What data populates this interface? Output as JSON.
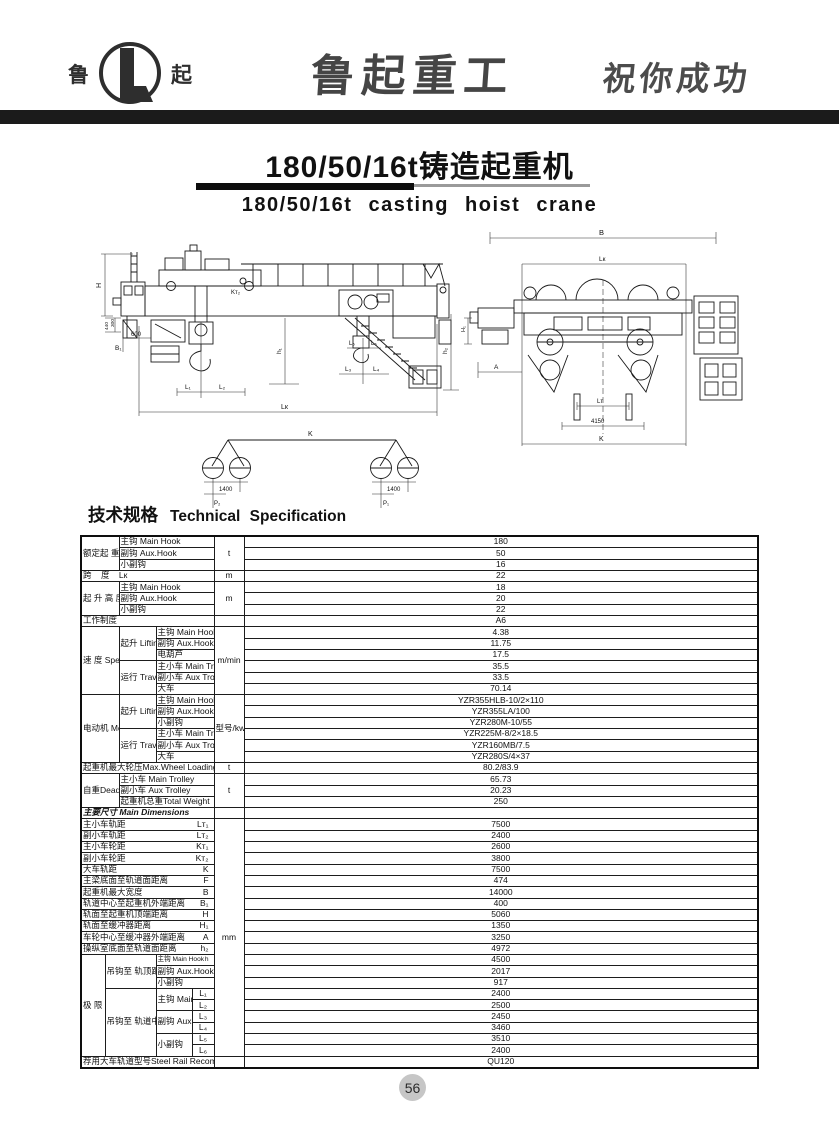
{
  "header": {
    "logo": {
      "left_char": "鲁",
      "right_char": "起"
    },
    "brand_calligraphy": "鲁起重工",
    "slogan_calligraphy": "祝你成功"
  },
  "title": {
    "zh": "180/50/16t铸造起重机",
    "en": "180/50/16t casting hoist crane"
  },
  "section_heading": {
    "zh": "技术规格",
    "en": "Technical Specification"
  },
  "page_number": "56",
  "drawings": {
    "front_view": {
      "labels": {
        "H": "H",
        "d300": "300",
        "d440": "440",
        "B1": "B₁",
        "d600": "600",
        "Kt2": "Kт₂",
        "h1": "h₁",
        "h2": "h₂",
        "L1": "L₁",
        "L2": "L₂",
        "L3": "L₃",
        "L4": "L₄",
        "L5": "L₅",
        "L6": "L₆",
        "Lk": "Lк"
      }
    },
    "end_view": {
      "labels": {
        "B": "B",
        "Lk": "Lк",
        "H1": "H₁",
        "A": "A",
        "Lt": "Lт",
        "d4150": "4150",
        "K": "K"
      }
    },
    "axle_detail": {
      "labels": {
        "K": "K",
        "gauge_left": "1400",
        "gauge_right": "1400",
        "P2": "P₂",
        "P1": "P₁"
      }
    }
  },
  "table": {
    "rows": [
      {
        "cells": [
          {
            "t": "额定起\n重量Cap.",
            "rs": 3,
            "cs": 2,
            "cls": "c"
          },
          {
            "t": "主钩  Main Hook",
            "cs": 3,
            "cls": "l"
          },
          {
            "t": "t",
            "rs": 3,
            "cls": "u"
          },
          {
            "t": "180",
            "cls": "v"
          }
        ]
      },
      {
        "cells": [
          {
            "t": "副钩  Aux.Hook",
            "cs": 3,
            "cls": "l"
          },
          {
            "t": "50",
            "cls": "v"
          }
        ]
      },
      {
        "cells": [
          {
            "t": "小副钩",
            "cs": 3,
            "cls": "l"
          },
          {
            "t": "16",
            "cls": "v"
          }
        ]
      },
      {
        "cells": [
          {
            "t": "跨    度    Lк",
            "cs": 5,
            "cls": "l"
          },
          {
            "t": "m",
            "cls": "u"
          },
          {
            "t": "22",
            "cls": "v"
          }
        ]
      },
      {
        "cells": [
          {
            "t": "起 升 高 度",
            "rs": 3,
            "cs": 2,
            "cls": "c"
          },
          {
            "t": "主钩  Main Hook",
            "cs": 3,
            "cls": "l"
          },
          {
            "t": "m",
            "rs": 3,
            "cls": "u"
          },
          {
            "t": "18",
            "cls": "v"
          }
        ]
      },
      {
        "cells": [
          {
            "t": "副钩  Aux.Hook",
            "cs": 3,
            "cls": "l"
          },
          {
            "t": "20",
            "cls": "v"
          }
        ]
      },
      {
        "cells": [
          {
            "t": "小副钩",
            "cs": 3,
            "cls": "l"
          },
          {
            "t": "22",
            "cls": "v"
          }
        ]
      },
      {
        "cells": [
          {
            "t": "工作制度",
            "cs": 5,
            "cls": "l"
          },
          {
            "t": "",
            "cls": "u"
          },
          {
            "t": "A6",
            "cls": "v"
          }
        ]
      },
      {
        "cells": [
          {
            "t": "速\n度\nSpeed",
            "rs": 6,
            "cs": 2,
            "cls": "c"
          },
          {
            "t": "起升\nLifting",
            "rs": 3,
            "cls": "c"
          },
          {
            "t": "主钩 Main Hook",
            "cs": 2,
            "cls": "ls"
          },
          {
            "t": "m/min",
            "rs": 6,
            "cls": "u"
          },
          {
            "t": "4.38",
            "cls": "v"
          }
        ]
      },
      {
        "cells": [
          {
            "t": "副钩 Aux.Hook",
            "cs": 2,
            "cls": "ls"
          },
          {
            "t": "11.75",
            "cls": "v"
          }
        ]
      },
      {
        "cells": [
          {
            "t": "电葫芦",
            "cs": 2,
            "cls": "ls"
          },
          {
            "t": "17.5",
            "cls": "v"
          }
        ]
      },
      {
        "cells": [
          {
            "t": "运行\nTraveling",
            "rs": 3,
            "cls": "c"
          },
          {
            "t": "主小车 Main Trolley",
            "cs": 2,
            "cls": "ls"
          },
          {
            "t": "35.5",
            "cls": "v"
          }
        ]
      },
      {
        "cells": [
          {
            "t": "副小车 Aux Trolley",
            "cs": 2,
            "cls": "ls"
          },
          {
            "t": "33.5",
            "cls": "v"
          }
        ]
      },
      {
        "cells": [
          {
            "t": "大车",
            "cs": 2,
            "cls": "ls"
          },
          {
            "t": "70.14",
            "cls": "v"
          }
        ]
      },
      {
        "cells": [
          {
            "t": "电动机\n\nMotor",
            "rs": 6,
            "cs": 2,
            "cls": "c"
          },
          {
            "t": "起升\nLifting",
            "rs": 3,
            "cls": "c"
          },
          {
            "t": "主钩 Main Hook",
            "cs": 2,
            "cls": "ls"
          },
          {
            "t": "型号/kw\nType/kw",
            "rs": 6,
            "cls": "u"
          },
          {
            "t": "YZR355HLB-10/2×110",
            "cls": "v"
          }
        ]
      },
      {
        "cells": [
          {
            "t": "副钩 Aux.Hook",
            "cs": 2,
            "cls": "ls"
          },
          {
            "t": "YZR355LA/100",
            "cls": "v"
          }
        ]
      },
      {
        "cells": [
          {
            "t": "小副钩",
            "cs": 2,
            "cls": "ls"
          },
          {
            "t": "YZR280M-10/55",
            "cls": "v"
          }
        ]
      },
      {
        "cells": [
          {
            "t": "运行\nTraveling",
            "rs": 3,
            "cls": "c"
          },
          {
            "t": "主小车 Main Trolley",
            "cs": 2,
            "cls": "ls"
          },
          {
            "t": "YZR225M-8/2×18.5",
            "cls": "v"
          }
        ]
      },
      {
        "cells": [
          {
            "t": "副小车 Aux Trolley",
            "cs": 2,
            "cls": "ls"
          },
          {
            "t": "YZR160MB/7.5",
            "cls": "v"
          }
        ]
      },
      {
        "cells": [
          {
            "t": "大车",
            "cs": 2,
            "cls": "ls"
          },
          {
            "t": "YZR280S/4×37",
            "cls": "v"
          }
        ]
      },
      {
        "cells": [
          {
            "t": "起重机最大轮压Max.Wheel Loading P₁/P₂",
            "cs": 5,
            "cls": "sm"
          },
          {
            "t": "t",
            "cls": "u"
          },
          {
            "t": "80.2/83.9",
            "cls": "v"
          }
        ]
      },
      {
        "cells": [
          {
            "t": "自重Dead-\nWeight",
            "rs": 3,
            "cs": 2,
            "cls": "c"
          },
          {
            "t": "主小车 Main Trolley",
            "cs": 3,
            "cls": "l"
          },
          {
            "t": "t",
            "rs": 3,
            "cls": "u"
          },
          {
            "t": "65.73",
            "cls": "v"
          }
        ]
      },
      {
        "cells": [
          {
            "t": "副小车 Aux Trolley",
            "cs": 3,
            "cls": "l"
          },
          {
            "t": "20.23",
            "cls": "v"
          }
        ]
      },
      {
        "cells": [
          {
            "t": "起重机总重Total Weight",
            "cs": 3,
            "cls": "l"
          },
          {
            "t": "250",
            "cls": "v"
          }
        ]
      },
      {
        "cells": [
          {
            "t": "主要尺寸 Main Dimensions",
            "cs": 5,
            "cls": "hdr"
          },
          {
            "t": "",
            "cls": "u"
          },
          {
            "t": "",
            "cls": "v"
          }
        ]
      },
      {
        "cells": [
          {
            "t": "主小车轨距",
            "sym": "Lт₁",
            "cs": 5,
            "cls": "dim"
          },
          {
            "t": "mm",
            "rs": 21,
            "cls": "u"
          },
          {
            "t": "7500",
            "cls": "v"
          }
        ]
      },
      {
        "cells": [
          {
            "t": "副小车轨距",
            "sym": "Lт₂",
            "cs": 5,
            "cls": "dim"
          },
          {
            "t": "2400",
            "cls": "v"
          }
        ]
      },
      {
        "cells": [
          {
            "t": "主小车轮距",
            "sym": "Kт₁",
            "cs": 5,
            "cls": "dim"
          },
          {
            "t": "2600",
            "cls": "v"
          }
        ]
      },
      {
        "cells": [
          {
            "t": "副小车轮距",
            "sym": "Kт₂",
            "cs": 5,
            "cls": "dim"
          },
          {
            "t": "3800",
            "cls": "v"
          }
        ]
      },
      {
        "cells": [
          {
            "t": "大车轨距",
            "sym": "K",
            "cs": 5,
            "cls": "dim"
          },
          {
            "t": "7500",
            "cls": "v"
          }
        ]
      },
      {
        "cells": [
          {
            "t": "主梁底面至轨道面距离",
            "sym": "F",
            "cs": 5,
            "cls": "dim"
          },
          {
            "t": "474",
            "cls": "v"
          }
        ]
      },
      {
        "cells": [
          {
            "t": "起重机最大宽度",
            "sym": "B",
            "cs": 5,
            "cls": "dim"
          },
          {
            "t": "14000",
            "cls": "v"
          }
        ]
      },
      {
        "cells": [
          {
            "t": "轨道中心至起重机外端距离",
            "sym": "B₁",
            "cs": 5,
            "cls": "dim"
          },
          {
            "t": "400",
            "cls": "v"
          }
        ]
      },
      {
        "cells": [
          {
            "t": "轨面至起重机顶端距离",
            "sym": "H",
            "cs": 5,
            "cls": "dim"
          },
          {
            "t": "5060",
            "cls": "v"
          }
        ]
      },
      {
        "cells": [
          {
            "t": "轨面至缓冲器距离",
            "sym": "H₁",
            "cs": 5,
            "cls": "dim"
          },
          {
            "t": "1350",
            "cls": "v"
          }
        ]
      },
      {
        "cells": [
          {
            "t": "车轮中心至缓冲器外端距离",
            "sym": "A",
            "cs": 5,
            "cls": "dim"
          },
          {
            "t": "3250",
            "cls": "v"
          }
        ]
      },
      {
        "cells": [
          {
            "t": "操纵室底面至轨道面距离",
            "sym": "h₂",
            "cs": 5,
            "cls": "dim"
          },
          {
            "t": "4972",
            "cls": "v"
          }
        ]
      },
      {
        "cells": [
          {
            "t": "极\n限\n位\n置",
            "rs": 9,
            "cls": "c"
          },
          {
            "t": "吊钩至\n轨顶距离",
            "rs": 3,
            "cs": 2,
            "cls": "c"
          },
          {
            "t": "主钩  Main Hook",
            "sym": "h",
            "cs": 2,
            "cls": "dim ls"
          },
          {
            "t": "4500",
            "cls": "v"
          }
        ]
      },
      {
        "cells": [
          {
            "t": "副钩  Aux.Hook",
            "cs": 2,
            "cls": "ls"
          },
          {
            "t": "2017",
            "cls": "v"
          }
        ]
      },
      {
        "cells": [
          {
            "t": "小副钩",
            "cs": 2,
            "cls": "ls"
          },
          {
            "t": "917",
            "cls": "v"
          }
        ]
      },
      {
        "cells": [
          {
            "t": "吊钩至\n轨道中\n心距离",
            "rs": 6,
            "cs": 2,
            "cls": "c"
          },
          {
            "t": "主钩 Main Hook",
            "rs": 2,
            "cls": "ls"
          },
          {
            "t": "L₁",
            "cls": "symc"
          },
          {
            "t": "2400",
            "cls": "v"
          }
        ]
      },
      {
        "cells": [
          {
            "t": "L₂",
            "cls": "symc"
          },
          {
            "t": "2500",
            "cls": "v"
          }
        ]
      },
      {
        "cells": [
          {
            "t": "副钩 Aux.Hook",
            "rs": 2,
            "cls": "ls"
          },
          {
            "t": "L₃",
            "cls": "symc"
          },
          {
            "t": "2450",
            "cls": "v"
          }
        ]
      },
      {
        "cells": [
          {
            "t": "L₄",
            "cls": "symc"
          },
          {
            "t": "3460",
            "cls": "v"
          }
        ]
      },
      {
        "cells": [
          {
            "t": "小副钩",
            "rs": 2,
            "cls": "ls"
          },
          {
            "t": "L₅",
            "cls": "symc"
          },
          {
            "t": "3510",
            "cls": "v"
          }
        ]
      },
      {
        "cells": [
          {
            "t": "L₆",
            "cls": "symc"
          },
          {
            "t": "2400",
            "cls": "v"
          }
        ]
      },
      {
        "cells": [
          {
            "t": "荐用大车轨道型号Steel Rail Recommended",
            "cs": 5,
            "cls": "sm"
          },
          {
            "t": "",
            "cls": "u"
          },
          {
            "t": "QU120",
            "cls": "v"
          }
        ]
      }
    ]
  }
}
